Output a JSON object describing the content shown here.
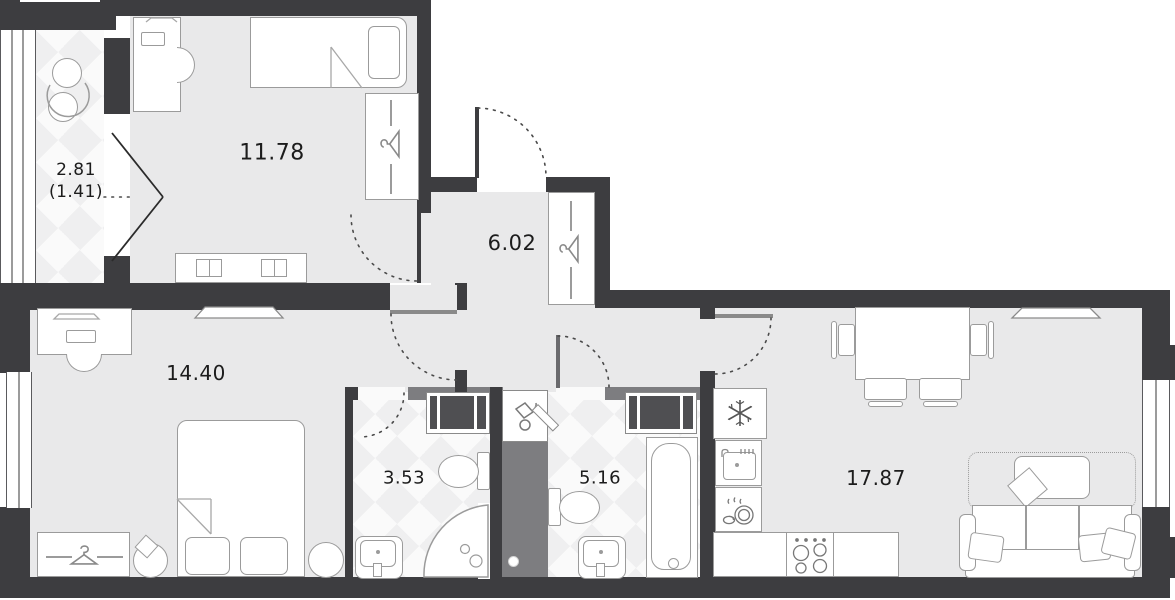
{
  "plan": {
    "rooms": {
      "bedroom1": {
        "label": "11.78"
      },
      "balcony": {
        "label_total": "2.81",
        "label_counted": "(1.41)"
      },
      "hallway": {
        "label": "6.02"
      },
      "bedroom2": {
        "label": "14.40"
      },
      "bathroom1": {
        "label": "3.53"
      },
      "bathroom2": {
        "label": "5.16"
      },
      "living_kitchen": {
        "label": "17.87"
      }
    },
    "colors": {
      "wall": "#3d3d40",
      "wall-light": "#7d7d80",
      "floor": "#e9e9ea",
      "tile": "#fafafa",
      "tile-alt": "#efeff0",
      "line": "#9b9b9b",
      "arc": "#4a4a4a",
      "text": "#1c1c1c"
    }
  }
}
